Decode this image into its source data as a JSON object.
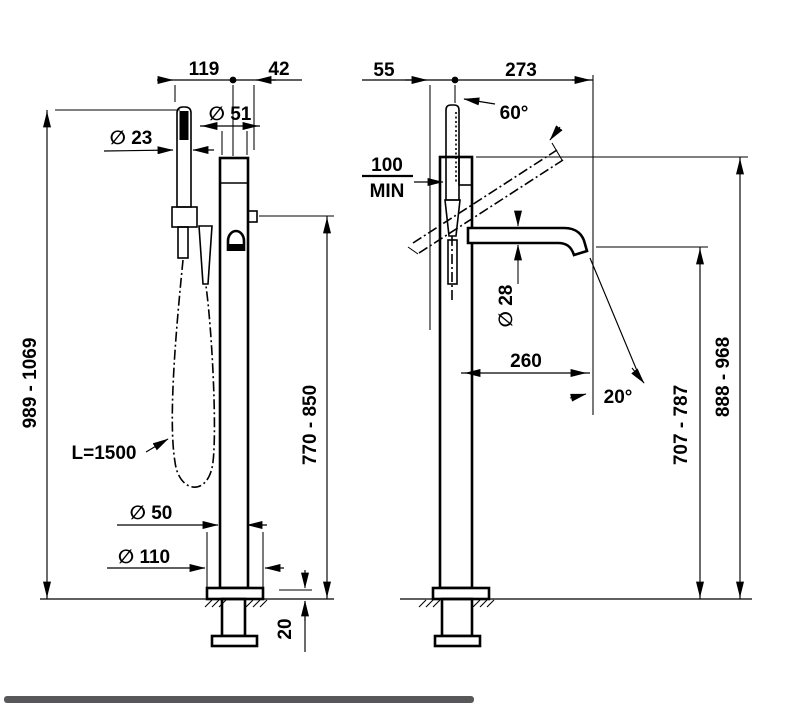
{
  "drawing": {
    "front": {
      "width_handshower_to_axis": "119",
      "width_axis_to_handle": "42",
      "handshower_diameter": "∅ 23",
      "column_top_diameter": "∅ 51",
      "total_height": "989 - 1069",
      "hose_length": "L=1500",
      "outlet_height": "770 - 850",
      "column_diameter": "∅ 50",
      "base_flange_diameter": "∅ 110",
      "base_flange_height": "20"
    },
    "side": {
      "wall_offset": "55",
      "reach_total": "273",
      "handshower_pullout_angle": "60°",
      "min_clearance_value": "100",
      "min_clearance_label": "MIN",
      "spout_diameter": "∅ 28",
      "spout_reach": "260",
      "spout_outlet_angle": "20°",
      "spout_outlet_height": "707 - 787",
      "handshower_outlet_height": "888 - 968"
    }
  }
}
